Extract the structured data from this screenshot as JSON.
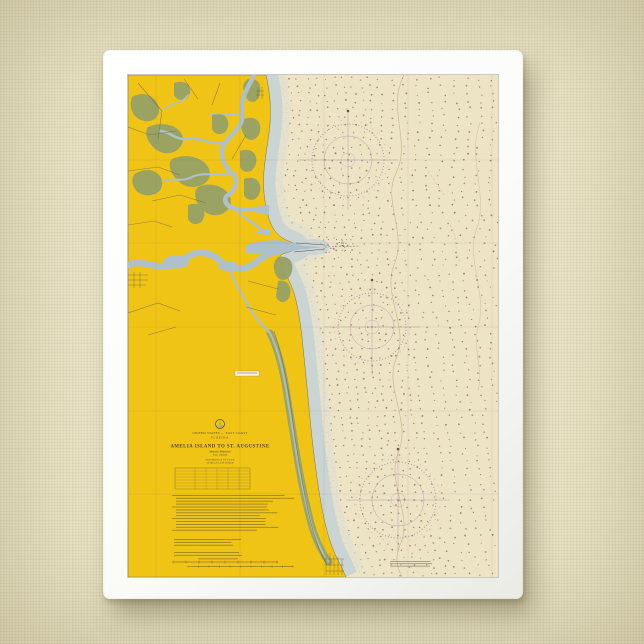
{
  "scene": {
    "wall_color": "#EBE4C4"
  },
  "frame": {
    "color": "#FBFBF8"
  },
  "chart": {
    "title_block": {
      "country_line": "UNITED STATES — EAST COAST",
      "state_line": "FLORIDA",
      "title": "AMELIA ISLAND TO ST. AUGUSTINE",
      "projection_line": "Mercator Projection",
      "scale_line": "Scale 1:80,000",
      "soundings_line_1": "SOUNDINGS IN FEET",
      "soundings_line_2": "AT MEAN LOW WATER",
      "seal_icon": "anchor-seal"
    },
    "colors": {
      "wall": "#EBE4C4",
      "frame": "#FBFBF8",
      "land": "#F0C414",
      "marsh": "#99A266",
      "water": "#AEC0CB",
      "ocean": "#EDE4C6",
      "rose": "#A87C9F",
      "ink": "#4A4437"
    }
  }
}
